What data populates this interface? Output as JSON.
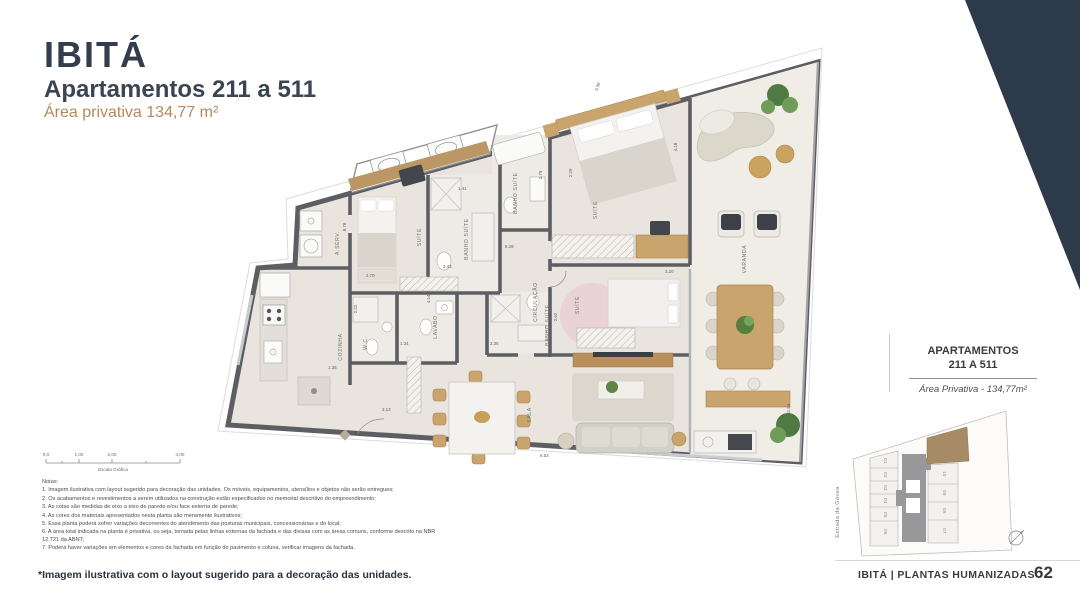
{
  "header": {
    "brand": "IBITÁ",
    "title": "Apartamentos 211 a 511",
    "area": "Área privativa 134,77 m²"
  },
  "plan": {
    "rooms": {
      "aserv": "A.SERV.",
      "cozinha": "COZINHA",
      "wc": "W.C.",
      "lavabo": "LAVABO",
      "circulacao": "CIRCULAÇÃO",
      "suite_1": "SUÍTE",
      "suite_2": "SUÍTE",
      "suite_3": "SUÍTE",
      "banho_suite_1": "BANHO SUÍTE",
      "banho_suite_2": "BANHO SUÍTE",
      "banho_suite_3": "BANHO SUÍTE",
      "sala": "SALA",
      "varanda": "VARANDA"
    },
    "dims": [
      "8.78",
      "3.36",
      "2.79",
      "2.29",
      "4.18",
      "1.41",
      "5.29",
      "4.27",
      "2.43",
      "4.14",
      "2.70",
      "2.22",
      "1.34",
      "1.36",
      "3.13",
      "2.36",
      "2.62",
      "3.20",
      "9.53",
      "11.54"
    ]
  },
  "scalebar": {
    "ticks": [
      "0,0",
      "1,00",
      "2,00",
      "4,00"
    ],
    "label": "Escala Gráfica"
  },
  "notes": {
    "title": "Notas:",
    "items": [
      "1. Imagem ilustrativa com layout sugerido para decoração das unidades. Os móveis, equipamentos, utensílios e objetos não serão entregues;",
      "2. Os acabamentos e revestimentos a serem utilizados na construção estão especificados no memorial descritivo do empreendimento;",
      "3. As cotas são medidas de eixo a eixo de parede e/ou face externa de parede;",
      "4. As cores dos materiais apresentados nesta planta são meramente ilustrativos;",
      "5. Essa planta poderá sofrer variações decorrentes do atendimento das posturas municipais, concessionárias e do local;",
      "6. A área total indicada na planta é privativa, ou seja, tomada pelas linhas externas da fachada e das divisas com as áreas comuns, conforme descrito na NBR 12.721 da ABNT;",
      "7. Poderá haver variações em elementos e cores da fachada em função do pavimento e coluna, verificar imagens da fachada."
    ]
  },
  "sidebar": {
    "title_line1": "APARTAMENTOS",
    "title_line2": "211 A 511",
    "area": "Área Privativa - 134,77m²"
  },
  "keyplan": {
    "street": "Estrada da Gávea",
    "units": [
      "01",
      "02",
      "03",
      "04",
      "05",
      "06",
      "07",
      "08",
      "09",
      "10",
      "11"
    ],
    "highlighted_unit": "11"
  },
  "footer": {
    "note": "*Imagem ilustrativa com o layout sugerido para a decoração das unidades.",
    "brandline": "IBITÁ | PLANTAS HUMANIZADAS",
    "page": "62"
  },
  "colors": {
    "navy": "#2d3a49",
    "tan": "#b5895c",
    "wall": "#5d5e64",
    "floor": "#e9e5de",
    "varanda_floor": "#f0ede6",
    "wood": "#c9a46c",
    "highlight_unit": "#a78a66"
  }
}
